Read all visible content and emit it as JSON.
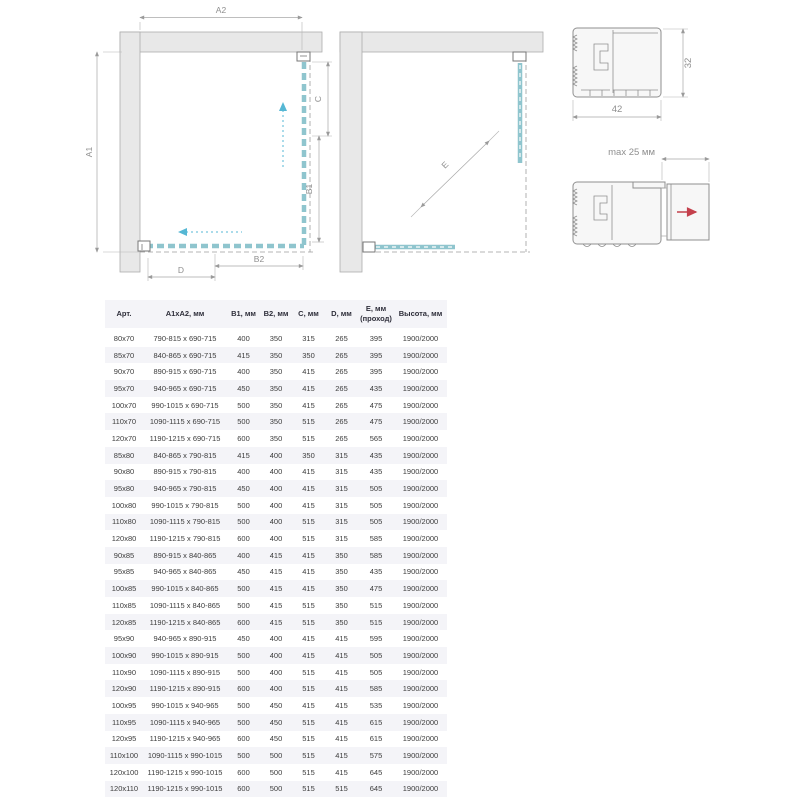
{
  "diagram_labels": {
    "a1": "A1",
    "a2": "A2",
    "b1": "B1",
    "b2": "B2",
    "c": "C",
    "d": "D",
    "e": "E",
    "w42": "42",
    "h32": "32",
    "max25": "max 25 мм"
  },
  "colors": {
    "glass_teal": "#8fc5ce",
    "wall_gray": "#e8e8e8",
    "dimension_gray": "#9a9a9a",
    "slide_arrow_blue": "#55b7d4",
    "extension_arrow_red": "#c4404c",
    "row_stripe": "#f4f4f8",
    "header_text": "#2e2e3a",
    "body_text": "#3c3c3c"
  },
  "table": {
    "headers": [
      "Арт.",
      "А1хА2, мм",
      "В1, мм",
      "В2, мм",
      "С, мм",
      "D, мм",
      "Е, мм\n(проход)",
      "Высота, мм"
    ],
    "rows": [
      [
        "80x70",
        "790-815 x 690-715",
        "400",
        "350",
        "315",
        "265",
        "395",
        "1900/2000"
      ],
      [
        "85x70",
        "840-865 x 690-715",
        "415",
        "350",
        "350",
        "265",
        "395",
        "1900/2000"
      ],
      [
        "90x70",
        "890-915 x 690-715",
        "400",
        "350",
        "415",
        "265",
        "395",
        "1900/2000"
      ],
      [
        "95x70",
        "940-965 x 690-715",
        "450",
        "350",
        "415",
        "265",
        "435",
        "1900/2000"
      ],
      [
        "100x70",
        "990-1015 x 690-715",
        "500",
        "350",
        "415",
        "265",
        "475",
        "1900/2000"
      ],
      [
        "110x70",
        "1090-1115 x 690-715",
        "500",
        "350",
        "515",
        "265",
        "475",
        "1900/2000"
      ],
      [
        "120x70",
        "1190-1215 x 690-715",
        "600",
        "350",
        "515",
        "265",
        "565",
        "1900/2000"
      ],
      [
        "85x80",
        "840-865 x 790-815",
        "415",
        "400",
        "350",
        "315",
        "435",
        "1900/2000"
      ],
      [
        "90x80",
        "890-915 x 790-815",
        "400",
        "400",
        "415",
        "315",
        "435",
        "1900/2000"
      ],
      [
        "95x80",
        "940-965 x 790-815",
        "450",
        "400",
        "415",
        "315",
        "505",
        "1900/2000"
      ],
      [
        "100x80",
        "990-1015 x 790-815",
        "500",
        "400",
        "415",
        "315",
        "505",
        "1900/2000"
      ],
      [
        "110x80",
        "1090-1115 x 790-815",
        "500",
        "400",
        "515",
        "315",
        "505",
        "1900/2000"
      ],
      [
        "120x80",
        "1190-1215 x 790-815",
        "600",
        "400",
        "515",
        "315",
        "585",
        "1900/2000"
      ],
      [
        "90x85",
        "890-915 x 840-865",
        "400",
        "415",
        "415",
        "350",
        "585",
        "1900/2000"
      ],
      [
        "95x85",
        "940-965 x 840-865",
        "450",
        "415",
        "415",
        "350",
        "435",
        "1900/2000"
      ],
      [
        "100x85",
        "990-1015 x 840-865",
        "500",
        "415",
        "415",
        "350",
        "475",
        "1900/2000"
      ],
      [
        "110x85",
        "1090-1115 x 840-865",
        "500",
        "415",
        "515",
        "350",
        "515",
        "1900/2000"
      ],
      [
        "120x85",
        "1190-1215 x 840-865",
        "600",
        "415",
        "515",
        "350",
        "515",
        "1900/2000"
      ],
      [
        "95x90",
        "940-965 x 890-915",
        "450",
        "400",
        "415",
        "415",
        "595",
        "1900/2000"
      ],
      [
        "100x90",
        "990-1015 x 890-915",
        "500",
        "400",
        "415",
        "415",
        "505",
        "1900/2000"
      ],
      [
        "110x90",
        "1090-1115 x 890-915",
        "500",
        "400",
        "515",
        "415",
        "505",
        "1900/2000"
      ],
      [
        "120x90",
        "1190-1215 x 890-915",
        "600",
        "400",
        "515",
        "415",
        "585",
        "1900/2000"
      ],
      [
        "100x95",
        "990-1015 x 940-965",
        "500",
        "450",
        "415",
        "415",
        "535",
        "1900/2000"
      ],
      [
        "110x95",
        "1090-1115 x 940-965",
        "500",
        "450",
        "515",
        "415",
        "615",
        "1900/2000"
      ],
      [
        "120x95",
        "1190-1215 x 940-965",
        "600",
        "450",
        "515",
        "415",
        "615",
        "1900/2000"
      ],
      [
        "110x100",
        "1090-1115 x 990-1015",
        "500",
        "500",
        "515",
        "415",
        "575",
        "1900/2000"
      ],
      [
        "120x100",
        "1190-1215 x 990-1015",
        "600",
        "500",
        "515",
        "415",
        "645",
        "1900/2000"
      ],
      [
        "120x110",
        "1190-1215 x 990-1015",
        "600",
        "500",
        "515",
        "515",
        "645",
        "1900/2000"
      ]
    ]
  }
}
